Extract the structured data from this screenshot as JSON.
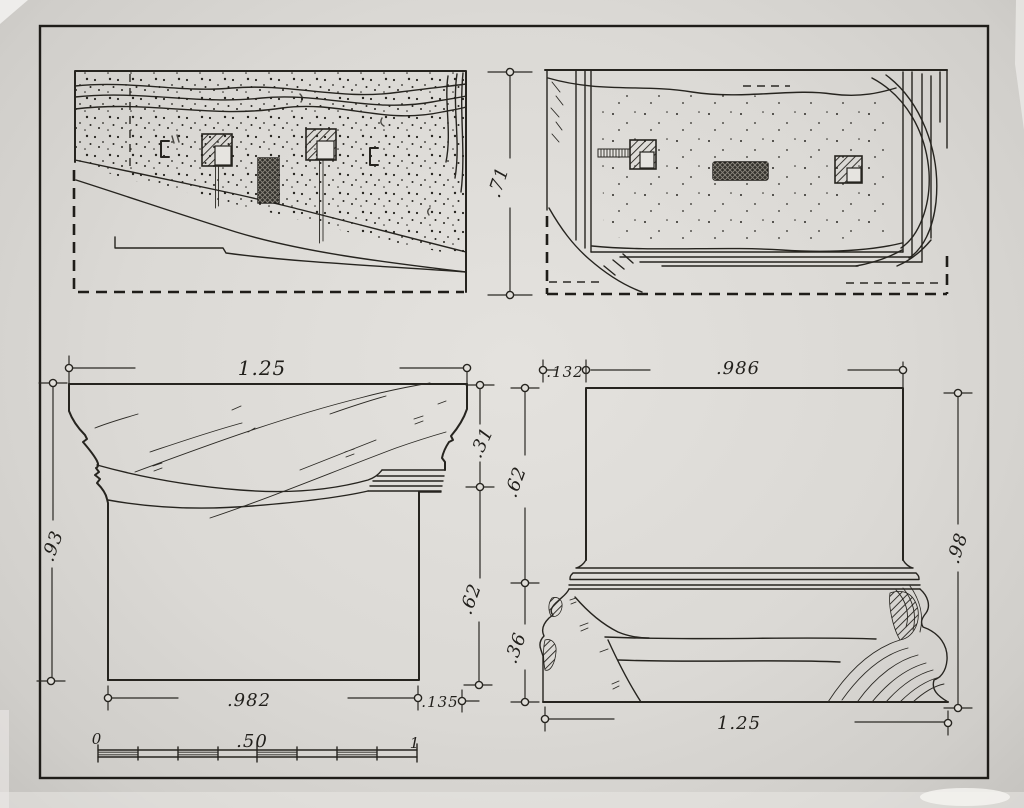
{
  "colors": {
    "paper": "#dcdad6",
    "mat": "#c5c3bf",
    "ink": "#26241f"
  },
  "labels": {
    "upper_plan": {
      "height": ".71"
    },
    "capital_elevation": {
      "top_width": "1.25",
      "cap_height": ".31",
      "shaft_height": ".62",
      "overall_height": ".93",
      "shaft_width": ".982",
      "projection": ".135"
    },
    "base_elevation": {
      "projection": ".132",
      "shaft_width": ".986",
      "upper_height": ".62",
      "lower_height": ".36",
      "overall_height": ".98",
      "bottom_width": "1.25"
    },
    "scale_bar": {
      "zero": "0",
      "half": ".50",
      "one": "1"
    }
  }
}
